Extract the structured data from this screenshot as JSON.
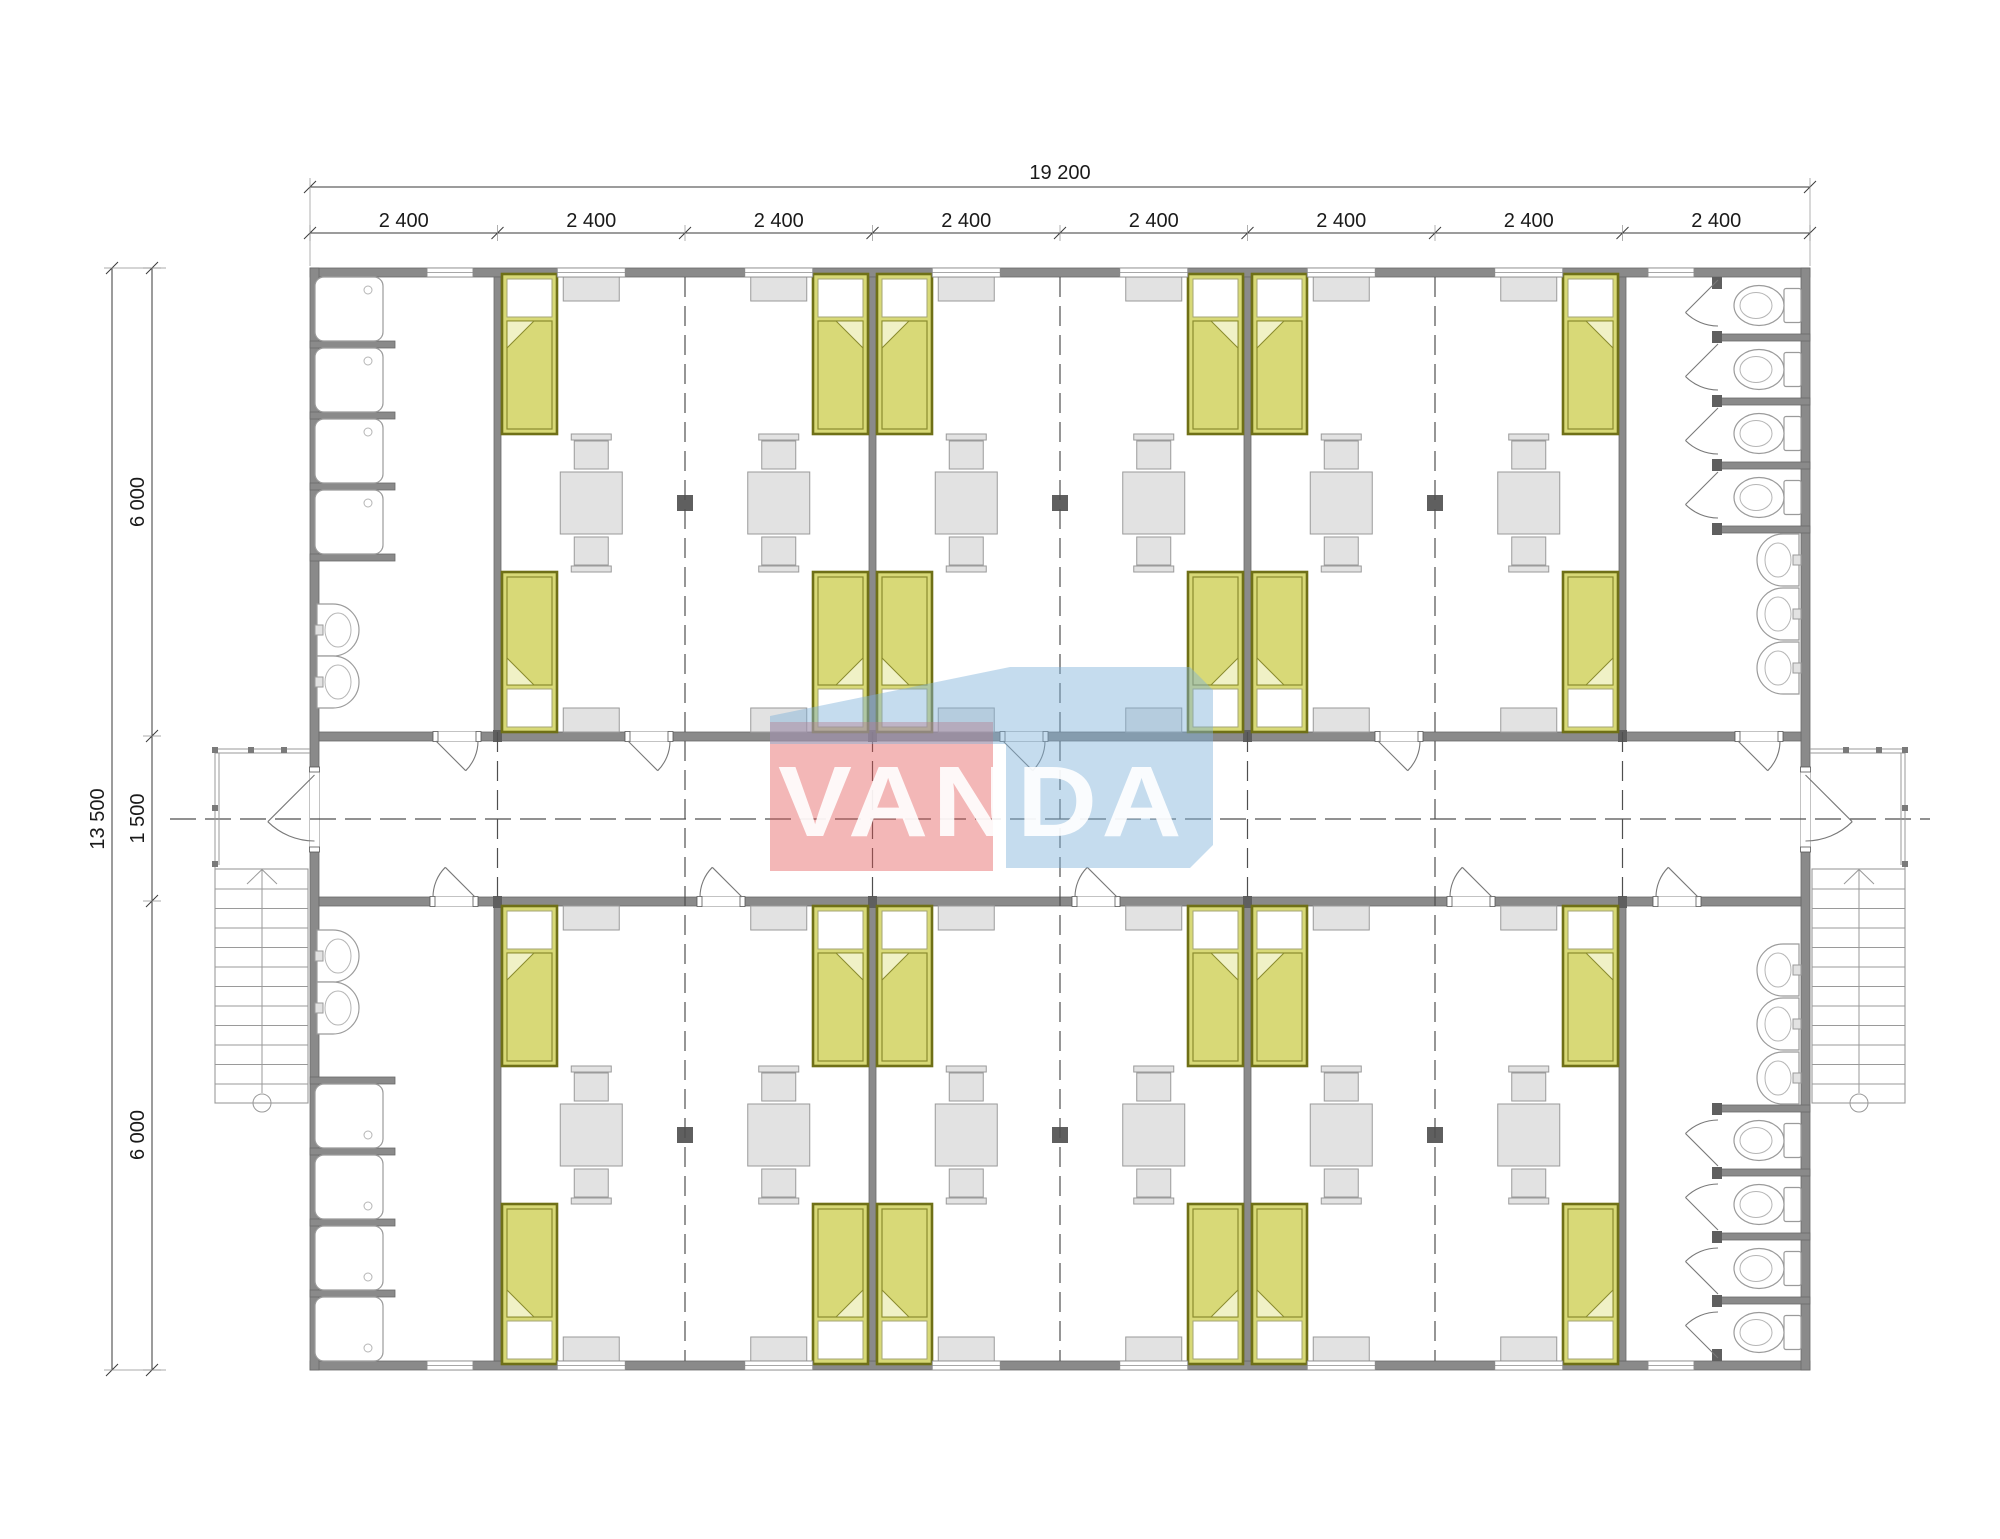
{
  "watermark": {
    "text": "VANDA",
    "red": "#e25353",
    "blue": "#7fb2d9",
    "text_color": "#ffffff"
  },
  "dimensions": {
    "top_total": "19 200",
    "top_segments": [
      "2 400",
      "2 400",
      "2 400",
      "2 400",
      "2 400",
      "2 400",
      "2 400",
      "2 400"
    ],
    "left_total": "13 500",
    "left_segments": [
      "6 000",
      "1 500",
      "6 000"
    ]
  },
  "colors": {
    "wall": "#8a8a8a",
    "wall_edge": "#6a6a6a",
    "bed_fill": "#d8d977",
    "bed_stroke": "#6f7017",
    "bed_stroke2": "#8a8b2e",
    "bed_fold": "#f0f1c6",
    "furniture": "#e2e2e2",
    "furniture_stroke": "#9a9a9a",
    "fixture_stroke": "#9b9b9b",
    "dim_text": "#1a1a1a"
  },
  "plan": {
    "building_width_mm": 19200,
    "building_depth_mm": 13500,
    "bay_width_mm": 2400,
    "bays": 8,
    "corridor_width_mm": 1500,
    "wing_depth_mm": 6000,
    "bedrooms_per_wing": 3,
    "beds_per_bedroom": 4,
    "tables_per_bedroom": 2,
    "chairs_per_table": 2,
    "left_bathroom_per_wing": {
      "showers": 4,
      "sinks": 2
    },
    "right_bathroom_per_wing": {
      "toilet_stalls": 4,
      "sinks": 3
    },
    "entrances": 2,
    "external_stairs": 2
  }
}
